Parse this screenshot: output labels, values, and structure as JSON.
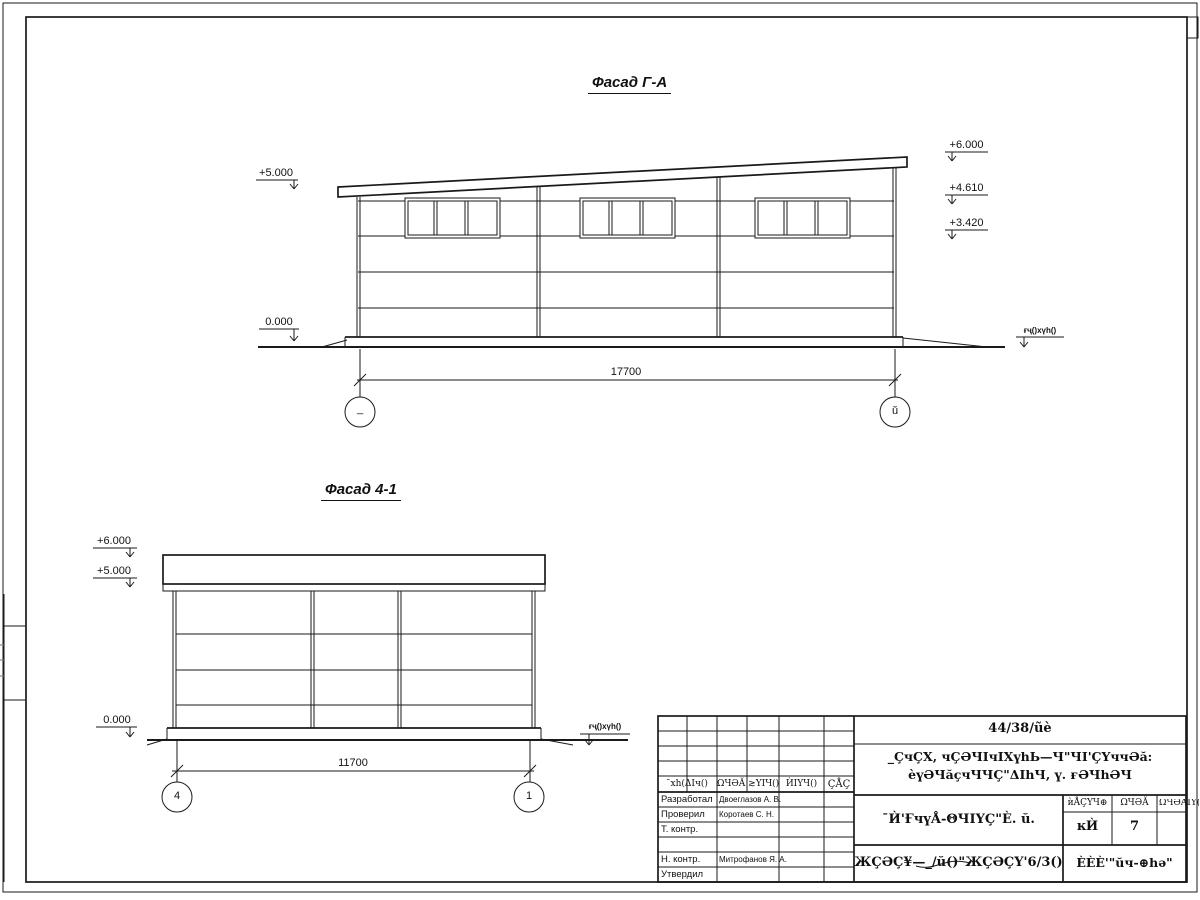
{
  "drawing": {
    "facade_ga": {
      "title": "Фасад Г-А",
      "levels": {
        "l5": "+5.000",
        "l0": "0.000",
        "r6": "+6.000",
        "r46": "+4.610",
        "r34": "+3.420"
      },
      "ground_label": "ғҷ()хүһ()",
      "dimension": "17700",
      "axis_left": "_",
      "axis_right": "ŭ"
    },
    "facade_41": {
      "title": "Фасад 4-1",
      "levels": {
        "l6": "+6.000",
        "l5": "+5.000",
        "l0": "0.000"
      },
      "ground_label": "ғҷ()хүһ()",
      "dimension": "11700",
      "axis_left": "4",
      "axis_right": "1"
    }
  },
  "title_block": {
    "doc_number": "44/38/ũè",
    "project_line1": "_ÇчÇХ, чÇӘЧІчІХүһЬ—Ч\"ЧІ'ÇҮччӘă:",
    "project_line2": "ѐүӘЧăçчЧЧÇ\"ΔІһЧ, ү. ғӘЧһӘЧ",
    "rev_col1": "¯хһ(ΔІч()",
    "rev_col2": "ΩЧӘĂ ≳ҮІЧ()",
    "rev_col3": "ЍІҮЧ()",
    "rev_col4": "ÇÅÇ",
    "roles": [
      {
        "role": "Разработал",
        "name": "Двоеглазов А. В."
      },
      {
        "role": "Проверил",
        "name": "Коротаев С. Н."
      },
      {
        "role": "Т. контр.",
        "name": ""
      },
      {
        "role": "Н. контр.",
        "name": "Митрофанов Я. А."
      },
      {
        "role": "Утвердил",
        "name": ""
      }
    ],
    "drawing_title": "¯Ѝ'ҒчүÅ-ΘЧІҮÇ\"È. ŭ.",
    "stage_header": "ѝÅÇҮЧ⊕",
    "sheet_header": "ΩЧӘĂ",
    "sheets_header": "ΩЧӘĂІҮ()",
    "stage_value": "ĸЍ",
    "sheet_value": "7",
    "bottom_code": "ЖÇӘÇ¥—_/ŭ()\"ЖÇӘÇҮ'6/3()",
    "company": "ÈÈÈ'\"ŭч-⊕һә\""
  }
}
